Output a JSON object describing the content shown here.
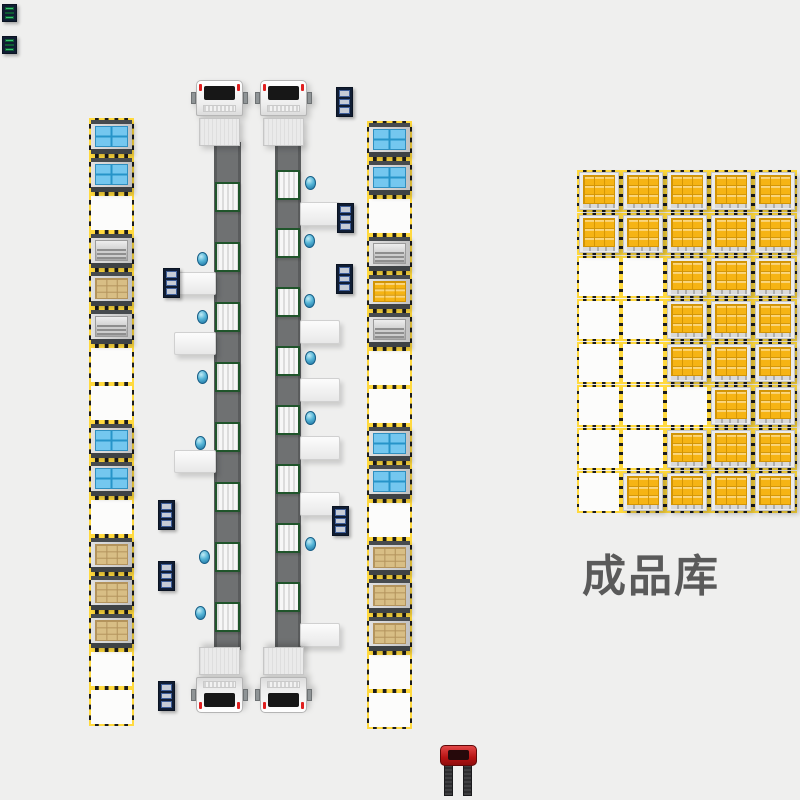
{
  "area_label": {
    "text": "成品库",
    "color": "#5a5a5a"
  },
  "colors": {
    "background": "#efefee",
    "hazard_yellow": "#ffd93e",
    "hazard_black": "#1c1c1c",
    "belt_gray": "#6f7172",
    "roller_border_green": "#20552b",
    "crate_blue": "#74c7ef",
    "cardboard_tan": "#d8be85",
    "gold_yellow": "#f6b414",
    "metal_silver": "#c9c9c9",
    "panel_navy": "#101d33",
    "marker_teal": "#54b4d6",
    "truck_white": "#f2f2f2",
    "forklift_red": "#b81313"
  },
  "load_names": {
    "blue": "pallet-blue-crate",
    "cardboard": "pallet-cardboard-boxes",
    "gold": "pallet-gold-boxes",
    "silver": "pallet-metal-stack",
    "empty": "empty-slot"
  },
  "left_rack": {
    "x": 90,
    "y": 119,
    "pitch": 38,
    "slot_w": 43,
    "slot_h": 36,
    "slots": [
      "blue",
      "blue",
      "empty",
      "silver",
      "cardboard",
      "silver",
      "empty",
      "empty",
      "blue",
      "blue",
      "empty",
      "cardboard",
      "cardboard",
      "cardboard",
      "empty",
      "empty"
    ]
  },
  "right_rack": {
    "x": 368,
    "y": 122,
    "pitch": 38,
    "slot_w": 43,
    "slot_h": 36,
    "slots": [
      "blue",
      "blue",
      "empty",
      "silver",
      "gold",
      "silver",
      "empty",
      "empty",
      "blue",
      "blue",
      "empty",
      "cardboard",
      "cardboard",
      "cardboard",
      "empty",
      "empty"
    ]
  },
  "conveyors": [
    {
      "x": 214,
      "w": 27,
      "top": 142,
      "bottom": 650,
      "rollers_y": [
        182,
        242,
        302,
        362,
        422,
        482,
        542,
        602
      ]
    },
    {
      "x": 275,
      "w": 26,
      "top": 142,
      "bottom": 650,
      "rollers_y": [
        170,
        228,
        287,
        346,
        405,
        464,
        523,
        582
      ]
    }
  ],
  "trucks": [
    {
      "x": 192,
      "y": 80,
      "facing": "up"
    },
    {
      "x": 256,
      "y": 80,
      "facing": "up"
    },
    {
      "x": 192,
      "y": 647,
      "facing": "down"
    },
    {
      "x": 256,
      "y": 647,
      "facing": "down"
    }
  ],
  "side_tables": [
    {
      "x": 174,
      "y": 272,
      "w": 42,
      "h": 23
    },
    {
      "x": 174,
      "y": 332,
      "w": 42,
      "h": 23
    },
    {
      "x": 174,
      "y": 450,
      "w": 42,
      "h": 23
    },
    {
      "x": 300,
      "y": 202,
      "w": 40,
      "h": 24
    },
    {
      "x": 300,
      "y": 320,
      "w": 40,
      "h": 24
    },
    {
      "x": 300,
      "y": 378,
      "w": 40,
      "h": 24
    },
    {
      "x": 300,
      "y": 436,
      "w": 40,
      "h": 24
    },
    {
      "x": 300,
      "y": 492,
      "w": 40,
      "h": 24
    },
    {
      "x": 300,
      "y": 623,
      "w": 40,
      "h": 24
    }
  ],
  "control_panels": [
    {
      "x": 336,
      "y": 87
    },
    {
      "x": 337,
      "y": 203
    },
    {
      "x": 336,
      "y": 264
    },
    {
      "x": 163,
      "y": 268
    },
    {
      "x": 158,
      "y": 500
    },
    {
      "x": 158,
      "y": 561
    },
    {
      "x": 332,
      "y": 506
    },
    {
      "x": 158,
      "y": 681
    }
  ],
  "agv_markers": [
    {
      "x": 197,
      "y": 252
    },
    {
      "x": 197,
      "y": 310
    },
    {
      "x": 197,
      "y": 370
    },
    {
      "x": 195,
      "y": 436
    },
    {
      "x": 199,
      "y": 550
    },
    {
      "x": 195,
      "y": 606
    },
    {
      "x": 305,
      "y": 176
    },
    {
      "x": 304,
      "y": 234
    },
    {
      "x": 304,
      "y": 294
    },
    {
      "x": 305,
      "y": 351
    },
    {
      "x": 305,
      "y": 411
    },
    {
      "x": 305,
      "y": 537
    }
  ],
  "finished_grid": {
    "x": 578,
    "y": 171,
    "cols": 5,
    "rows": 8,
    "pitch_x": 44,
    "pitch_y": 43,
    "cell_w": 42,
    "cell_h": 40,
    "matrix": [
      [
        1,
        1,
        1,
        1,
        1
      ],
      [
        1,
        1,
        1,
        1,
        1
      ],
      [
        0,
        0,
        1,
        1,
        1
      ],
      [
        0,
        0,
        1,
        1,
        1
      ],
      [
        0,
        0,
        1,
        1,
        1
      ],
      [
        0,
        0,
        0,
        1,
        1
      ],
      [
        0,
        0,
        1,
        1,
        1
      ],
      [
        0,
        1,
        1,
        1,
        1
      ]
    ]
  },
  "forklift": {
    "x": 440,
    "y": 745
  },
  "status_chips": [
    {
      "x": 2,
      "y": 4
    },
    {
      "x": 2,
      "y": 36
    }
  ]
}
